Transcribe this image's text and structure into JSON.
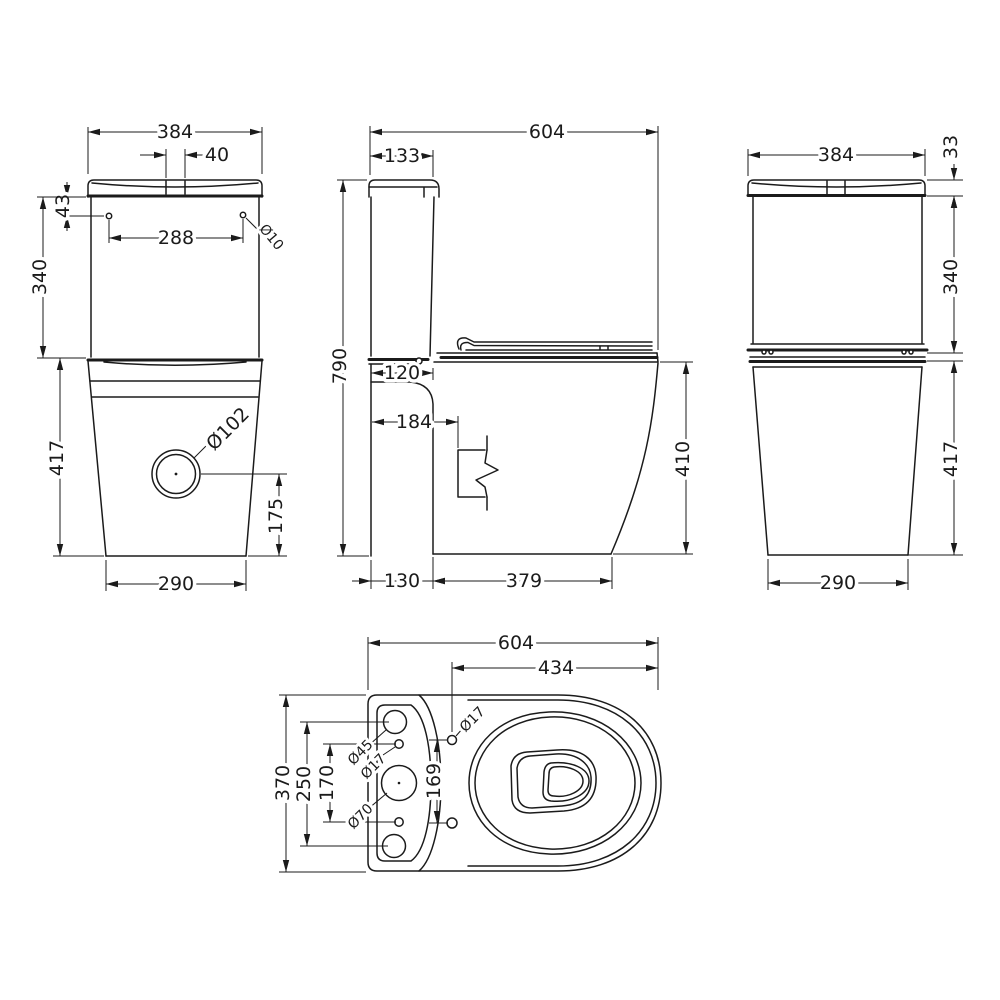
{
  "drawing": {
    "background": "#ffffff",
    "line_color": "#1b1b1b",
    "views": {
      "front": {
        "dims": {
          "overall_width": "384",
          "button_width": "40",
          "hole_top_offset": "43",
          "hole_spacing": "288",
          "hole_diameter": "Ø10",
          "cistern_height": "340",
          "pan_height": "417",
          "outlet_diameter": "Ø102",
          "outlet_center_height": "175",
          "base_width": "290"
        }
      },
      "side": {
        "dims": {
          "overall_depth": "604",
          "lid_depth": "133",
          "overall_height": "790",
          "ledge_depth": "120",
          "outlet_offset": "184",
          "rim_height": "410",
          "back_offset": "130",
          "foot_depth": "379"
        }
      },
      "back": {
        "dims": {
          "overall_width": "384",
          "lid_height": "33",
          "cistern_height": "340",
          "pan_height": "417",
          "base_width": "290"
        }
      },
      "top": {
        "dims": {
          "overall_depth": "604",
          "seat_hole_to_front": "434",
          "overall_width": "370",
          "outer_hole_spacing": "250",
          "inner_hole_spacing": "170",
          "seat_hole_spacing": "169",
          "inlet_hole_diameter": "Ø45",
          "fixing_hole_diameter": "Ø17",
          "flush_hole_diameter": "Ø70",
          "seat_hole_diameter": "Ø17"
        }
      }
    }
  }
}
